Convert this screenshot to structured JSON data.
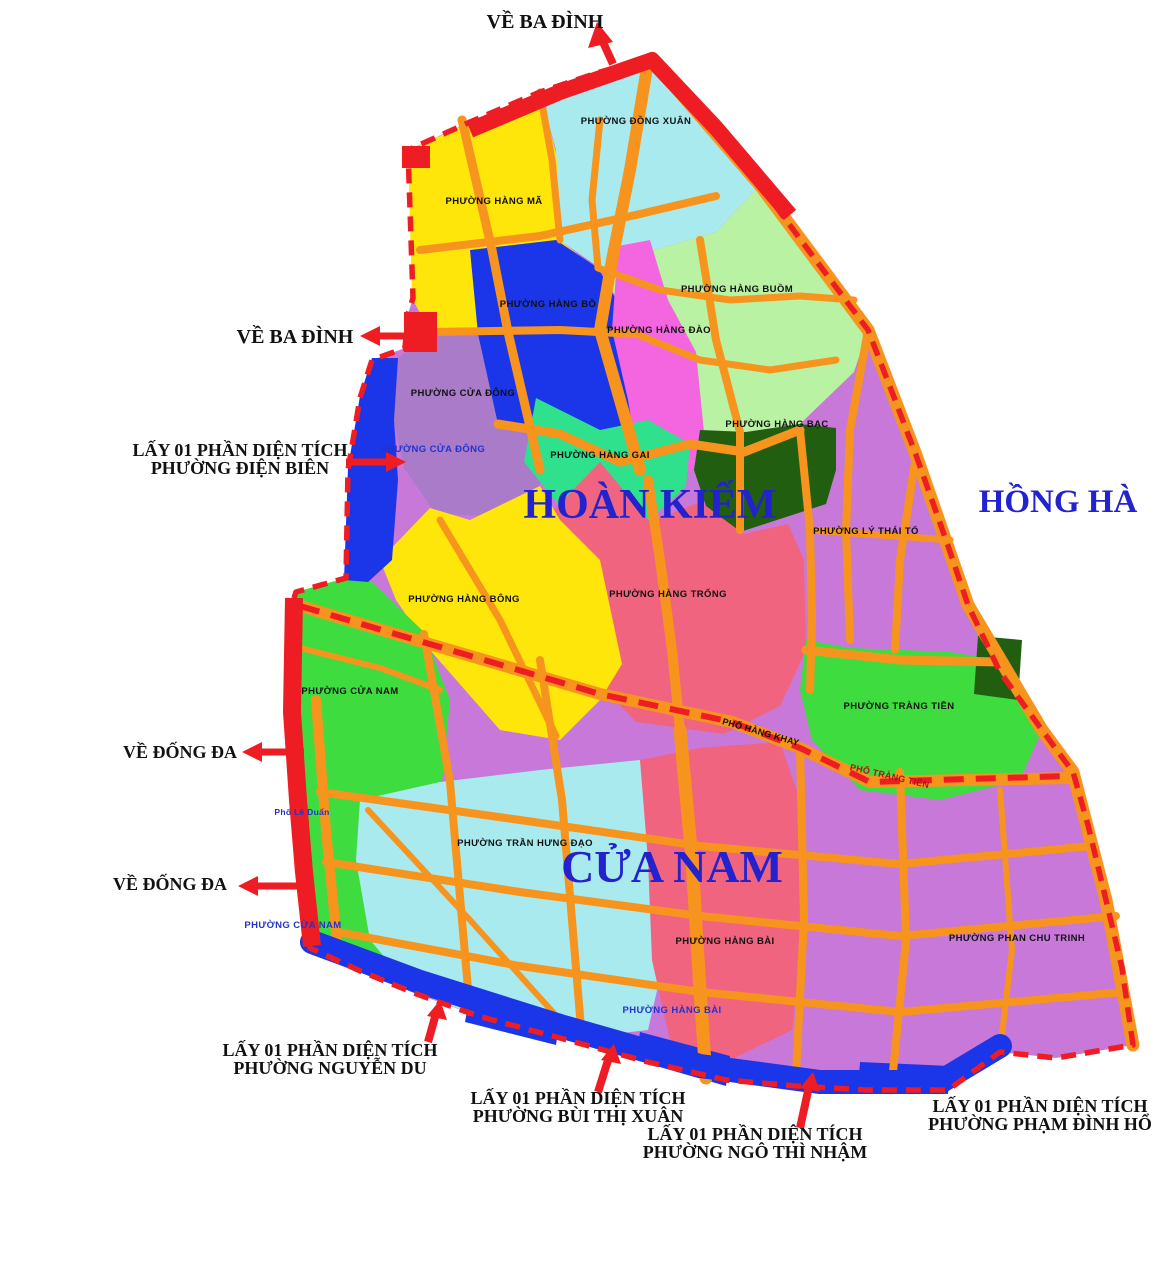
{
  "colors": {
    "background": "#ffffff",
    "road": "#f7941e",
    "boundary": "#ee1c23",
    "strip_blue": "#1a36e8",
    "district_title_blue": "#2222ce",
    "callout_black": "#111111",
    "ward_label_black": "#111111",
    "ward_label_blue": "#2233cc",
    "street_red": "#b01216",
    "base_violet": "#c878d8"
  },
  "regions": {
    "dong_xuan": {
      "name": "PHƯỜNG ĐỒNG XUÂN",
      "color": "#a8eaee"
    },
    "hang_ma": {
      "name": "PHƯỜNG HÀNG MÃ",
      "color": "#ffe60a"
    },
    "hang_buom": {
      "name": "PHƯỜNG HÀNG BUỒM",
      "color": "#b9f2a3"
    },
    "hang_bo": {
      "name": "PHƯỜNG HÀNG BỒ",
      "color": "#1a36e8"
    },
    "hang_dao": {
      "name": "PHƯỜNG HÀNG ĐÀO",
      "color": "#f466e0"
    },
    "hang_bac": {
      "name": "PHƯỜNG HÀNG BẠC",
      "color": "#215e0f"
    },
    "cua_dong": {
      "name": "PHƯỜNG CỬA ĐÔNG",
      "color": "#a97bc9"
    },
    "hang_gai": {
      "name": "PHƯỜNG HÀNG GAI",
      "color": "#2fe08c"
    },
    "ly_thai_to": {
      "name": "PHƯỜNG LÝ THÁI TỔ",
      "color": "#c878d8"
    },
    "hang_trong": {
      "name": "PHƯỜNG HÀNG TRỐNG",
      "color": "#f1647f"
    },
    "hang_bong": {
      "name": "PHƯỜNG HÀNG BÔNG",
      "color": "#ffe60a"
    },
    "cua_nam": {
      "name": "PHƯỜNG CỬA NAM",
      "color": "#3fdc3f"
    },
    "trang_tien": {
      "name": "PHƯỜNG TRÀNG TIỀN",
      "color": "#3fdc3f"
    },
    "tran_hung_dao": {
      "name": "PHƯỜNG TRẦN HƯNG ĐẠO",
      "color": "#a8eaee"
    },
    "hang_bai": {
      "name": "PHƯỜNG HÀNG BÀI",
      "color": "#f1647f"
    },
    "phan_chu_trinh": {
      "name": "PHƯỜNG PHAN CHU TRINH",
      "color": "#c878d8"
    }
  },
  "district_titles": {
    "hoan_kiem": "HOÀN KIẾM",
    "cua_nam": "CỬA NAM",
    "hong_ha": "HỒNG HÀ"
  },
  "streets": {
    "pho_hang_khay": "PHỐ HÀNG KHAY",
    "pho_trang_tien": "PHỐ TRÀNG TIỀN",
    "pho_le_duan": "Phố Lê Duẩn"
  },
  "callouts": {
    "ve_ba_dinh_top": "VỀ BA ĐÌNH",
    "ve_ba_dinh_left": "VỀ BA ĐÌNH",
    "ve_dong_da_1": "VỀ ĐỐNG ĐA",
    "ve_dong_da_2": "VỀ ĐỐNG ĐA",
    "lay_line": "LẤY 01 PHẦN DIỆN TÍCH",
    "dien_bien": "PHƯỜNG ĐIỆN BIÊN",
    "nguyen_du": "PHƯỜNG NGUYỄN DU",
    "bui_thi_xuan": "PHƯỜNG BÙI THỊ XUÂN",
    "ngo_thi_nham": "PHƯỜNG NGÔ THÌ NHẬM",
    "pham_dinh_ho": "PHƯỜNG PHẠM ĐÌNH HỔ"
  }
}
